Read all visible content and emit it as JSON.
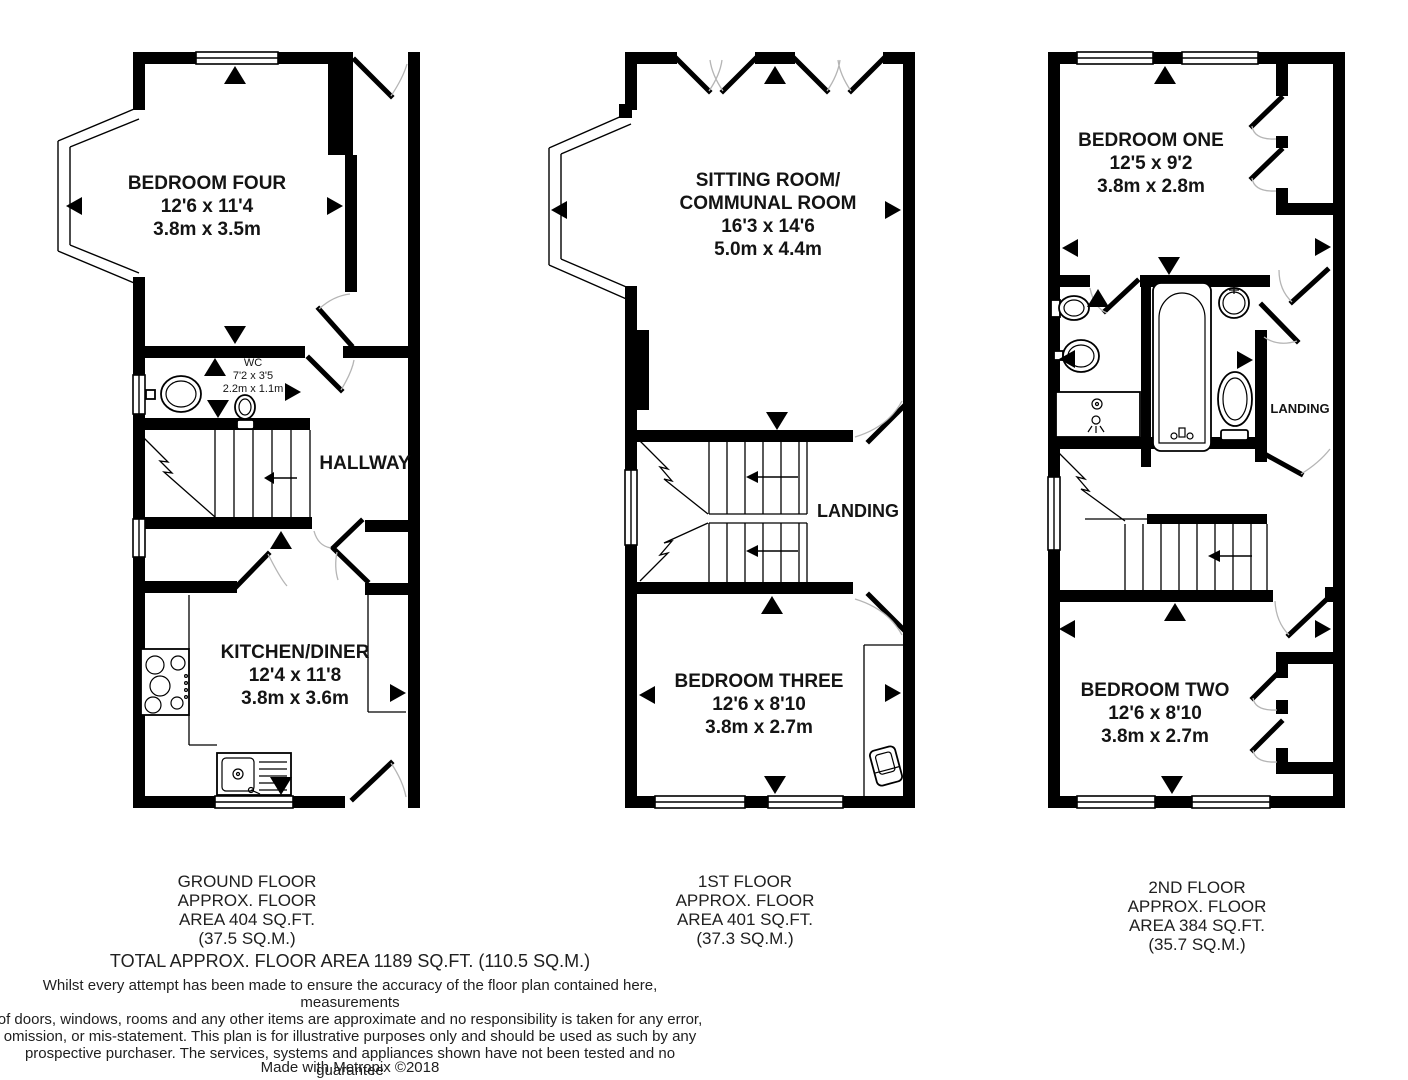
{
  "floors": [
    {
      "caption_lines": [
        "GROUND FLOOR",
        "APPROX. FLOOR",
        "AREA 404 SQ.FT.",
        "(37.5 SQ.M.)"
      ],
      "rooms": {
        "bedroom_four": {
          "name": "BEDROOM FOUR",
          "imperial": "12'6 x 11'4",
          "metric": "3.8m x 3.5m"
        },
        "wc": {
          "name": "WC",
          "imperial": "7'2 x 3'5",
          "metric": "2.2m x 1.1m"
        },
        "hallway": {
          "name": "HALLWAY"
        },
        "kitchen_diner": {
          "name": "KITCHEN/DINER",
          "imperial": "12'4 x 11'8",
          "metric": "3.8m x 3.6m"
        }
      }
    },
    {
      "caption_lines": [
        "1ST FLOOR",
        "APPROX. FLOOR",
        "AREA 401 SQ.FT.",
        "(37.3 SQ.M.)"
      ],
      "rooms": {
        "sitting_room": {
          "name_line1": "SITTING ROOM/",
          "name_line2": "COMMUNAL ROOM",
          "imperial": "16'3 x 14'6",
          "metric": "5.0m x 4.4m"
        },
        "landing": {
          "name": "LANDING"
        },
        "bedroom_three": {
          "name": "BEDROOM THREE",
          "imperial": "12'6 x 8'10",
          "metric": "3.8m x 2.7m"
        }
      }
    },
    {
      "caption_lines": [
        "2ND FLOOR",
        "APPROX. FLOOR",
        "AREA 384 SQ.FT.",
        "(35.7 SQ.M.)"
      ],
      "rooms": {
        "bedroom_one": {
          "name": "BEDROOM ONE",
          "imperial": "12'5 x 9'2",
          "metric": "3.8m x 2.8m"
        },
        "landing": {
          "name": "LANDING"
        },
        "bedroom_two": {
          "name": "BEDROOM TWO",
          "imperial": "12'6 x 8'10",
          "metric": "3.8m x 2.7m"
        }
      }
    }
  ],
  "total_area": "TOTAL APPROX. FLOOR AREA 1189 SQ.FT. (110.5 SQ.M.)",
  "disclaimer_lines": [
    "Whilst every attempt has been made to ensure the accuracy of the floor plan contained here, measurements",
    "of doors, windows, rooms and any other items are approximate and no responsibility is taken for any error,",
    "omission, or mis-statement. This plan is for illustrative purposes only and should be used as such by any",
    "prospective purchaser. The services, systems and appliances shown have not been tested and no guarantee",
    "as to their operability or efficiency can be given"
  ],
  "credit": "Made with Metropix ©2018",
  "colors": {
    "wall": "#000000",
    "background": "#ffffff",
    "door_arc": "#b5b5b5"
  }
}
